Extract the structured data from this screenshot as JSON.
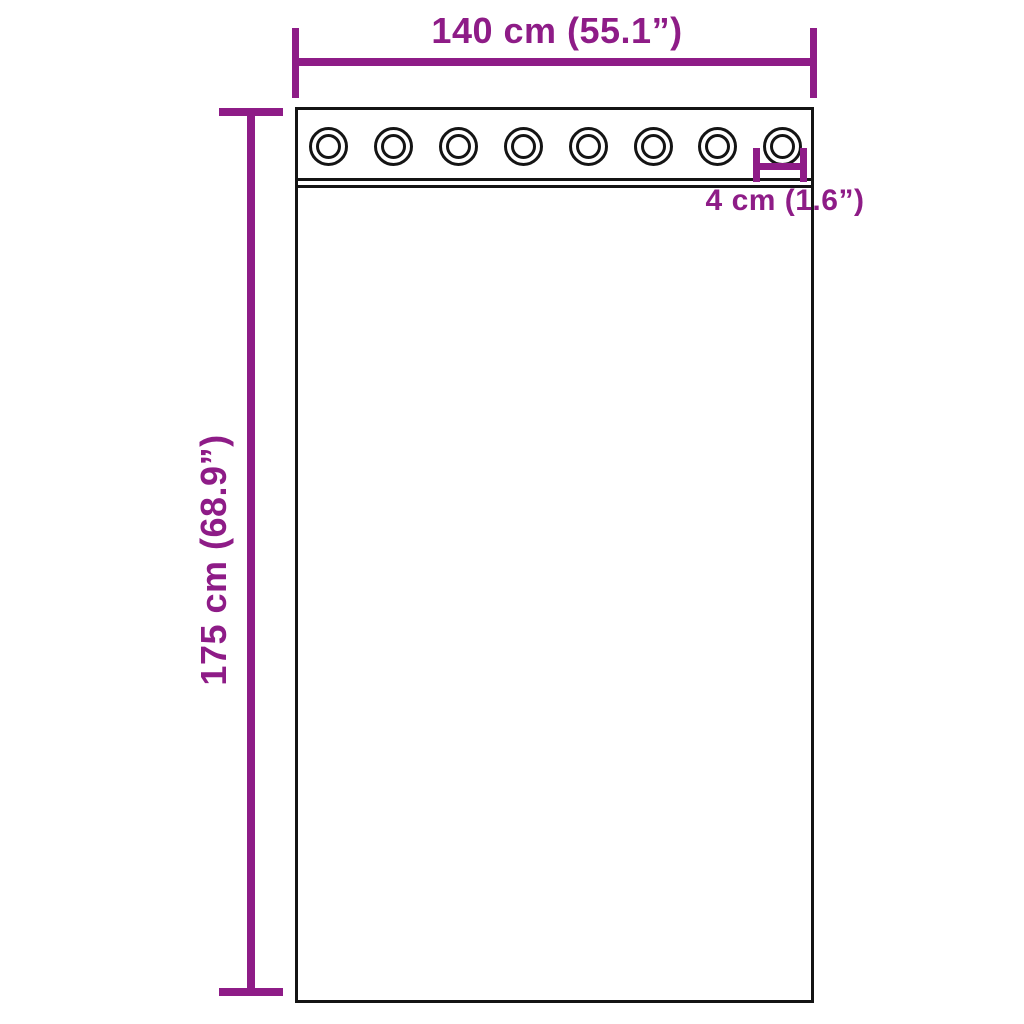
{
  "diagram": {
    "kind": "product-dimension-diagram",
    "subject": "grommet-curtain",
    "labels": {
      "width": "140 cm (55.1”)",
      "height": "175 cm (68.9”)",
      "grommet_diameter": "4 cm (1.6”)"
    },
    "grommets": {
      "count": 8
    },
    "colors": {
      "dimension": "#8E1C87",
      "outline": "#141414",
      "background": "#FFFFFF"
    }
  }
}
